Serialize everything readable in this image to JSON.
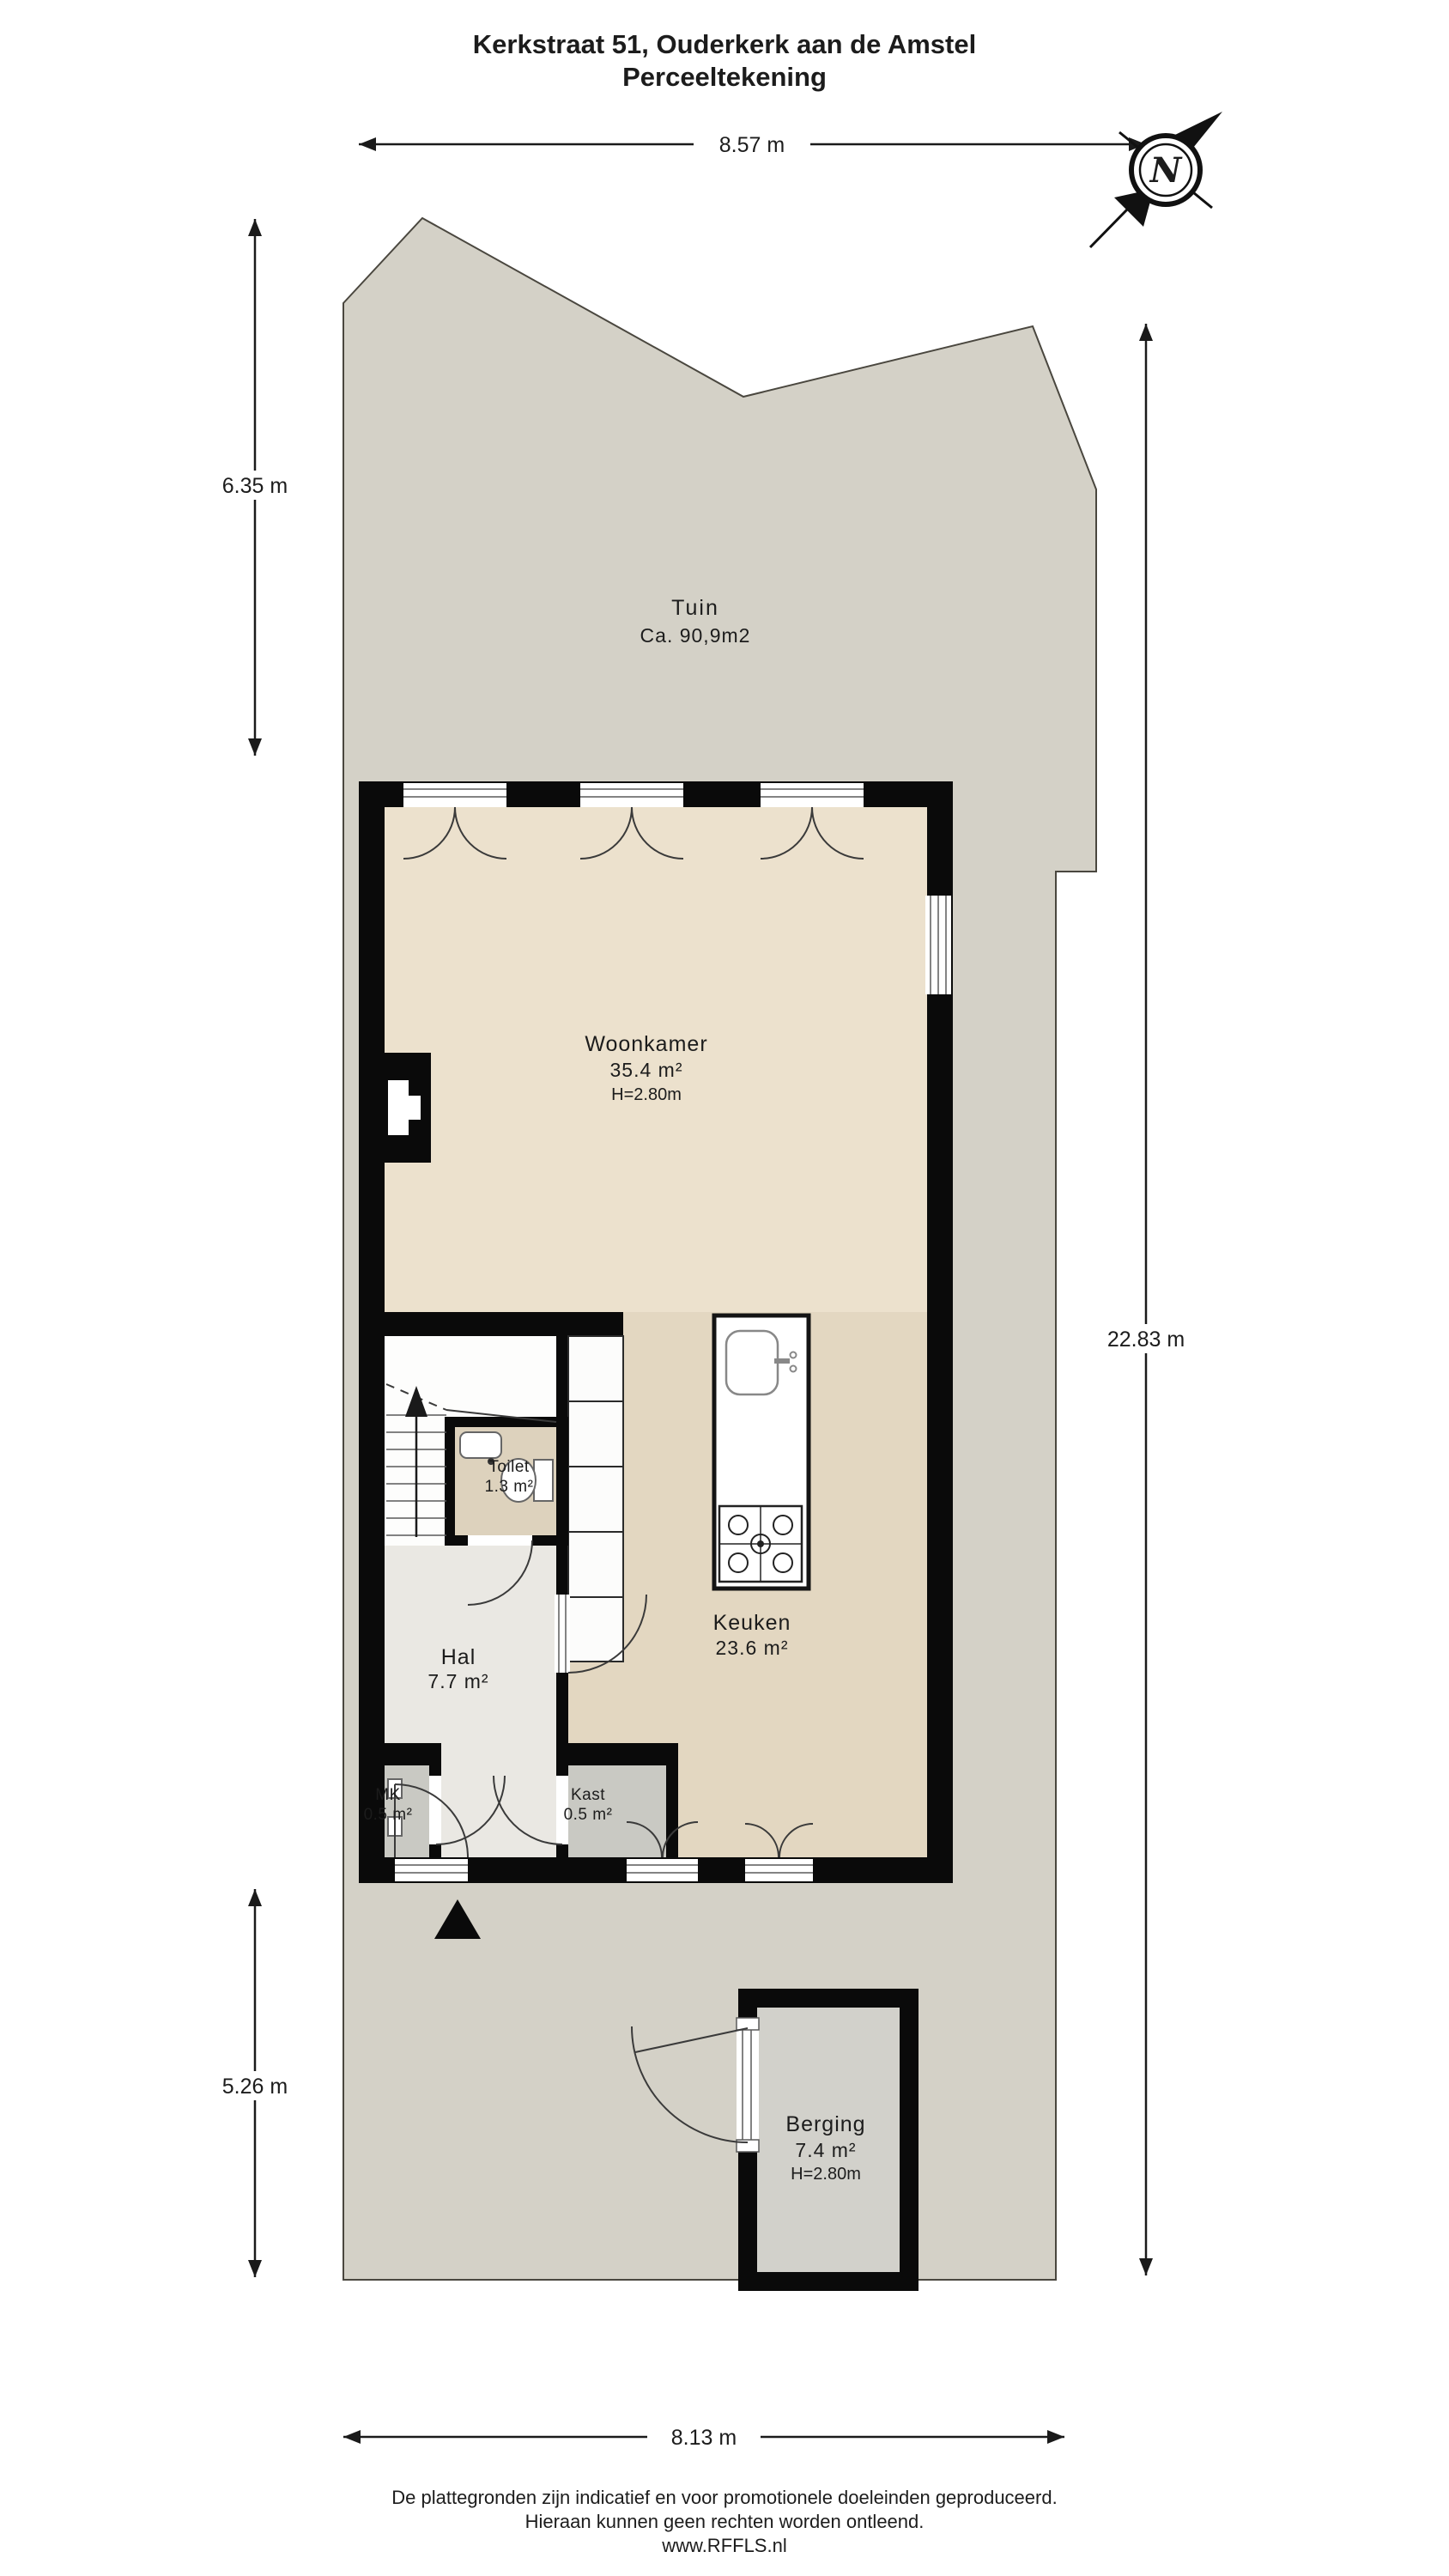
{
  "title": {
    "line1": "Kerkstraat 51, Ouderkerk aan de Amstel",
    "line2": "Perceeltekening"
  },
  "compass": {
    "north_label": "N"
  },
  "dimensions": {
    "top": "8.57 m",
    "garden_left": "6.35 m",
    "rear_left": "5.26 m",
    "right": "22.83 m",
    "bottom": "8.13 m"
  },
  "rooms": {
    "tuin": {
      "name": "Tuin",
      "area": "Ca. 90,9m2"
    },
    "woonkamer": {
      "name": "Woonkamer",
      "area": "35.4 m²",
      "ceiling": "H=2.80m"
    },
    "keuken": {
      "name": "Keuken",
      "area": "23.6 m²"
    },
    "toilet": {
      "name": "Toilet",
      "area": "1.3 m²"
    },
    "hal": {
      "name": "Hal",
      "area": "7.7 m²"
    },
    "mk": {
      "name": "MK",
      "area": "0.5 m²"
    },
    "kast": {
      "name": "Kast",
      "area": "0.5 m²"
    },
    "berging": {
      "name": "Berging",
      "area": "7.4 m²",
      "ceiling": "H=2.80m"
    }
  },
  "footer": {
    "line1": "De plattegronden zijn indicatief en voor promotionele doeleinden geproduceerd.",
    "line2": "Hieraan kunnen geen rechten worden ontleend.",
    "line3": "www.RFFLS.nl"
  },
  "colors": {
    "terrain": "#d4d1c7",
    "wall": "#0a0a0a",
    "woonkamer_floor": "#ece1cd",
    "keuken_floor": "#e3d7c1",
    "toilet_floor": "#ddd2bd",
    "hal_floor": "#eae8e3",
    "closet_floor": "#c9c9c3",
    "berging_floor": "#d2d1cb"
  }
}
